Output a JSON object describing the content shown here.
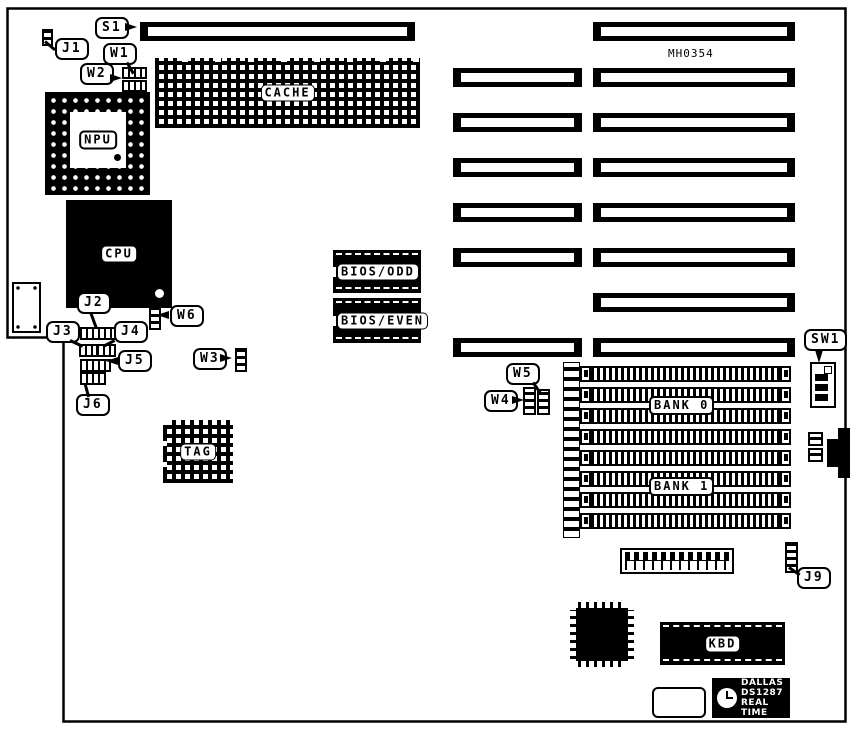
{
  "board": {
    "part_number": "MH0354"
  },
  "labels": {
    "s1": "S1",
    "j1": "J1",
    "w1": "W1",
    "w2": "W2",
    "j2": "J2",
    "j3": "J3",
    "j4": "J4",
    "j5": "J5",
    "j6": "J6",
    "w3": "W3",
    "w4": "W4",
    "w5": "W5",
    "w6": "W6",
    "sw1": "SW1",
    "j9": "J9"
  },
  "chips": {
    "cache": "CACHE",
    "npu": "NPU",
    "cpu": "CPU",
    "bios_odd": "BIOS/ODD",
    "bios_even": "BIOS/EVEN",
    "tag": "TAG",
    "bank0": "BANK 0",
    "bank1": "BANK 1",
    "kbd": "KBD"
  },
  "rtc": {
    "brand": "DALLAS",
    "model": "DS1287",
    "tagline": "REAL TIME"
  }
}
